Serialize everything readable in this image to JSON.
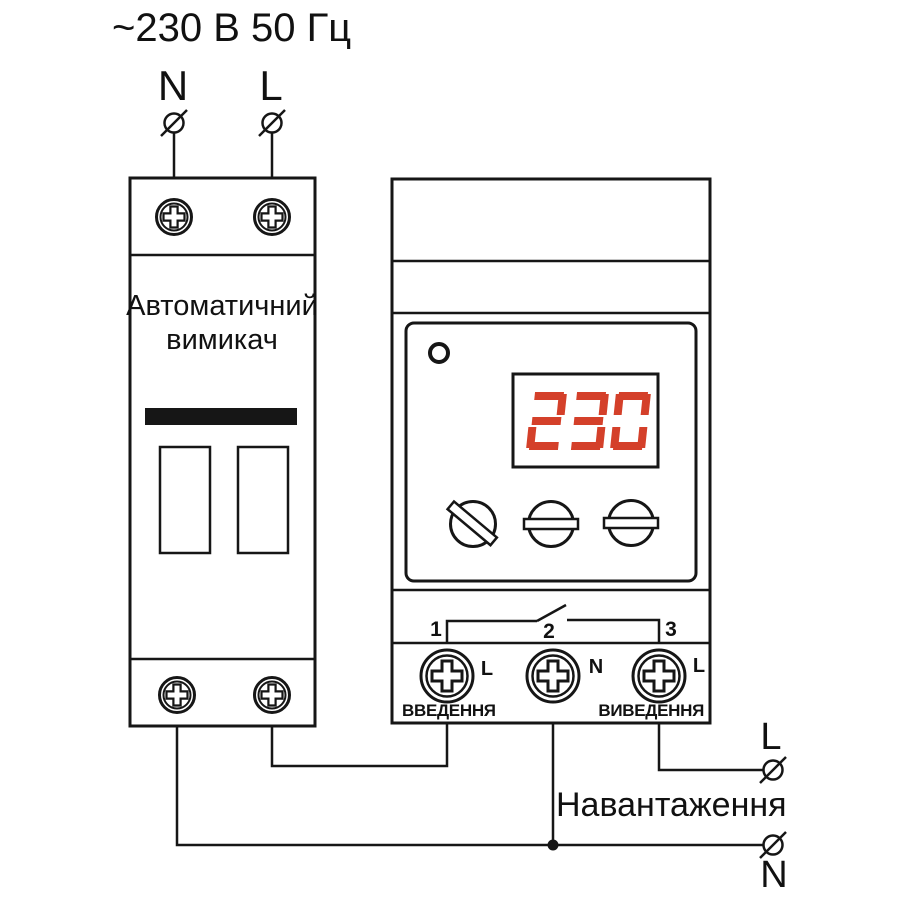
{
  "colors": {
    "line": "#161616",
    "display_digit": "#d4402a"
  },
  "supply": {
    "title": "~230 В 50 Гц",
    "neutral_label": "N",
    "line_label": "L"
  },
  "breaker": {
    "name_line1": "Автоматичний",
    "name_line2": "вимикач"
  },
  "relay": {
    "display_value": "230",
    "terminals": [
      {
        "number": "1",
        "wire_label": "L"
      },
      {
        "number": "2",
        "wire_label": "N"
      },
      {
        "number": "3",
        "wire_label": "L"
      }
    ],
    "input_label": "ВВЕДЕННЯ",
    "output_label": "ВИВЕДЕННЯ"
  },
  "load": {
    "label": "Навантаження",
    "line_label": "L",
    "neutral_label": "N"
  }
}
